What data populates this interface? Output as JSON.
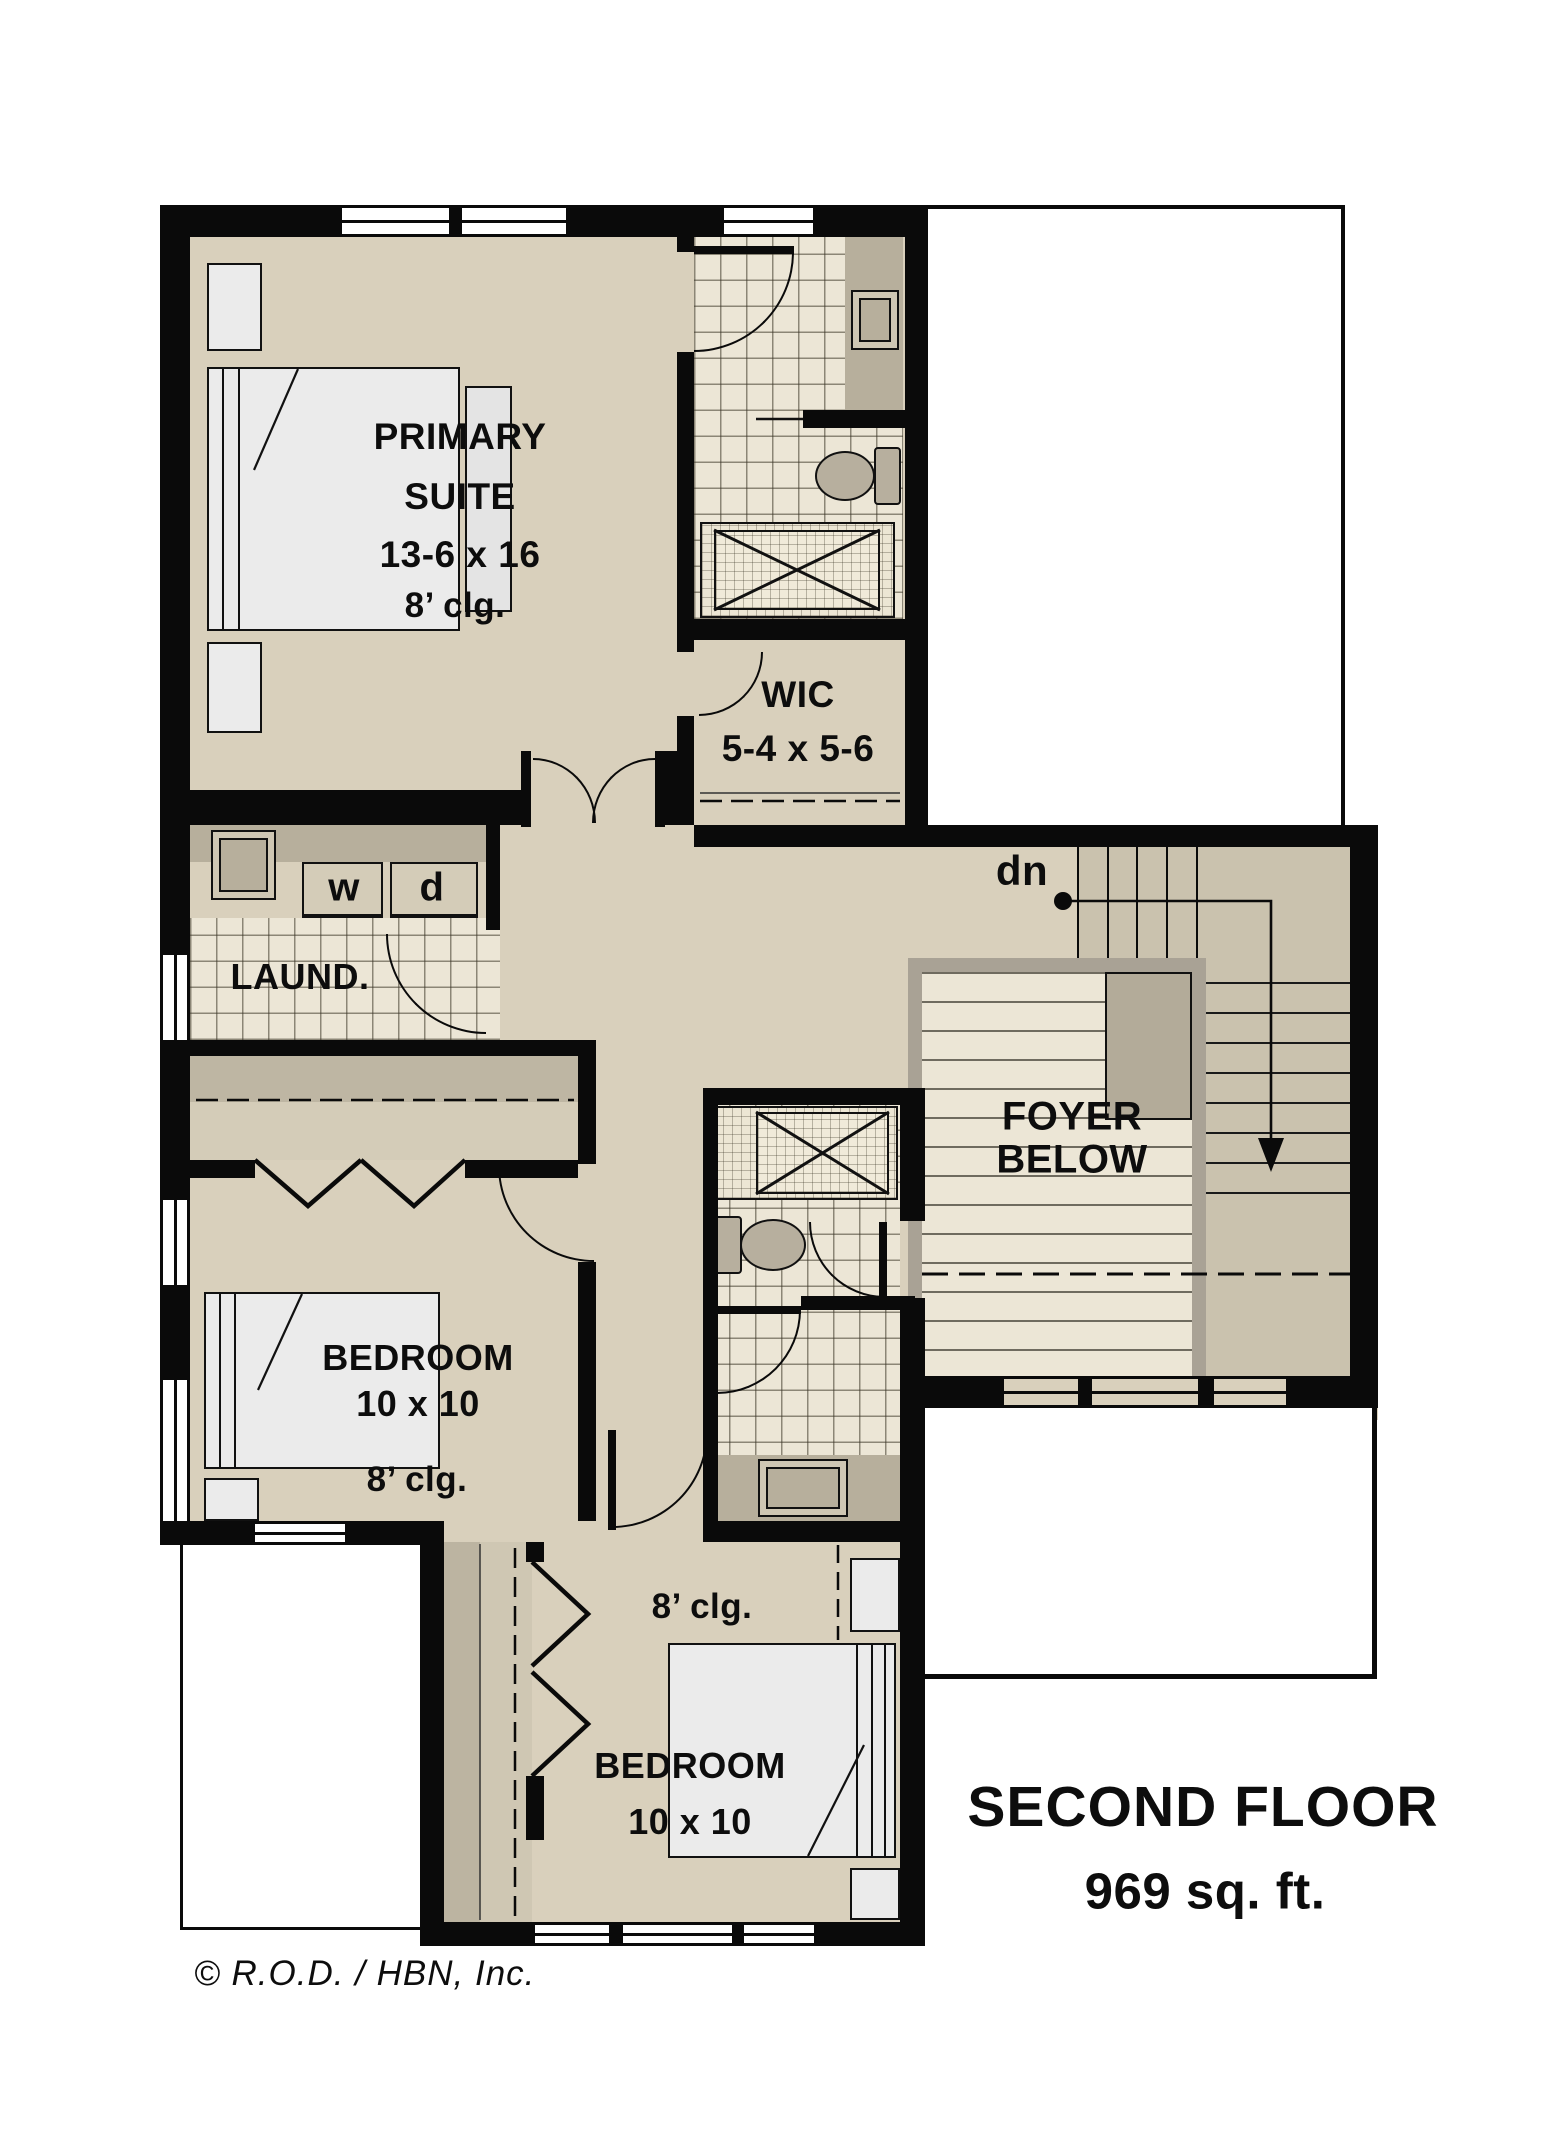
{
  "plan_title": {
    "line1": "SECOND FLOOR",
    "line2": "969 sq. ft."
  },
  "copyright": "© R.O.D. / HBN, Inc.",
  "rooms": {
    "primary_suite": {
      "label_line1": "PRIMARY",
      "label_line2": "SUITE",
      "dimensions": "13-6 x 16",
      "ceiling": "8’ clg."
    },
    "wic": {
      "label": "WIC",
      "dimensions": "5-4 x 5-6"
    },
    "laundry": {
      "label": "LAUND.",
      "washer_label": "w",
      "dryer_label": "d"
    },
    "bedroom_left": {
      "label": "BEDROOM",
      "dimensions": "10 x 10",
      "ceiling": "8’ clg."
    },
    "bedroom_bottom": {
      "label": "BEDROOM",
      "dimensions": "10 x 10",
      "ceiling": "8’ clg."
    },
    "foyer_below": {
      "label_line1": "FOYER",
      "label_line2": "BELOW"
    },
    "stairs": {
      "direction_label": "dn"
    }
  },
  "colors": {
    "floor_tan": "#d9d0bc",
    "wall_black": "#0a0a0a",
    "tile_cream": "#ece6d6",
    "counter_tan": "#b7af9c"
  }
}
